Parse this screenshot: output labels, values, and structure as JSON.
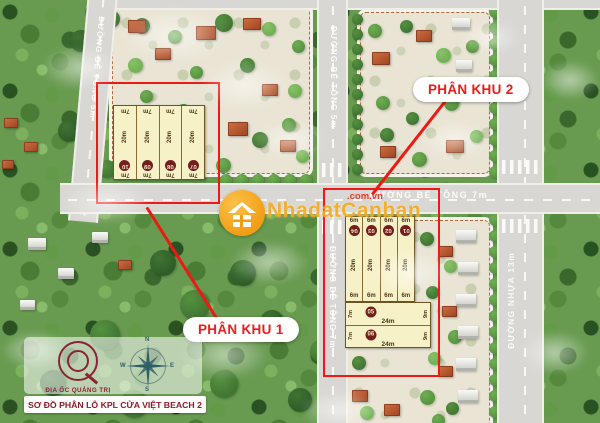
{
  "map_title": "SƠ ĐỒ PHÂN LÔ KPL CỬA VIỆT BEACH 2",
  "roads": {
    "left_vertical": "ĐƯỜNG BÊ TÔNG 5m",
    "center_top_vertical": "ĐƯỜNG BÊ TÔNG 5m",
    "center_bottom_vertical": "ĐƯỜNG BÊ TÔNG 7m",
    "middle_horizontal": "ĐƯỜNG BÊ TÔNG  7m",
    "right_vertical": "ĐƯỜNG NHỰA 13m"
  },
  "zones": {
    "zone1": {
      "label": "PHÂN KHU 1",
      "plots": [
        {
          "number": "10",
          "top": "7m",
          "length": "20m",
          "bottom": "7m"
        },
        {
          "number": "09",
          "top": "7m",
          "length": "20m",
          "bottom": "7m"
        },
        {
          "number": "08",
          "top": "7m",
          "length": "20m",
          "bottom": "7m"
        },
        {
          "number": "07",
          "top": "7m",
          "length": "20m",
          "bottom": "7m"
        }
      ]
    },
    "zone2": {
      "label": "PHÂN KHU 2",
      "vertical_plots": [
        {
          "number": "04",
          "top": "6m",
          "length": "20m",
          "bottom": "6m"
        },
        {
          "number": "03",
          "top": "6m",
          "length": "20m",
          "bottom": "6m"
        },
        {
          "number": "02",
          "top": "6m",
          "length": "20m",
          "bottom": "6m"
        },
        {
          "number": "01",
          "top": "6m",
          "length": "20m",
          "bottom": "6m"
        }
      ],
      "horizontal_plots": [
        {
          "number": "05",
          "left": "7m",
          "width": "24m",
          "right": "9m"
        },
        {
          "number": "06",
          "left": "7m",
          "width": "24m",
          "right": "9m"
        }
      ]
    }
  },
  "watermark": {
    "brand": "NhadatCanban",
    "domain": ".com.vn"
  },
  "branding": {
    "agency": "ĐỊA ỐC QUẢNG TRỊ"
  },
  "compass": {
    "n": "N",
    "e": "E",
    "s": "S",
    "w": "W"
  },
  "colors": {
    "annotation_red": "#ef1815",
    "plot_fill": "#f7f1c8",
    "plot_border": "#6f5424",
    "plot_number_bg": "#731f1f",
    "watermark_orange": "#f2a51c",
    "brand_maroon": "#8a2433",
    "compass_teal": "#2f6067",
    "road_gray": "#d8d7d3"
  }
}
